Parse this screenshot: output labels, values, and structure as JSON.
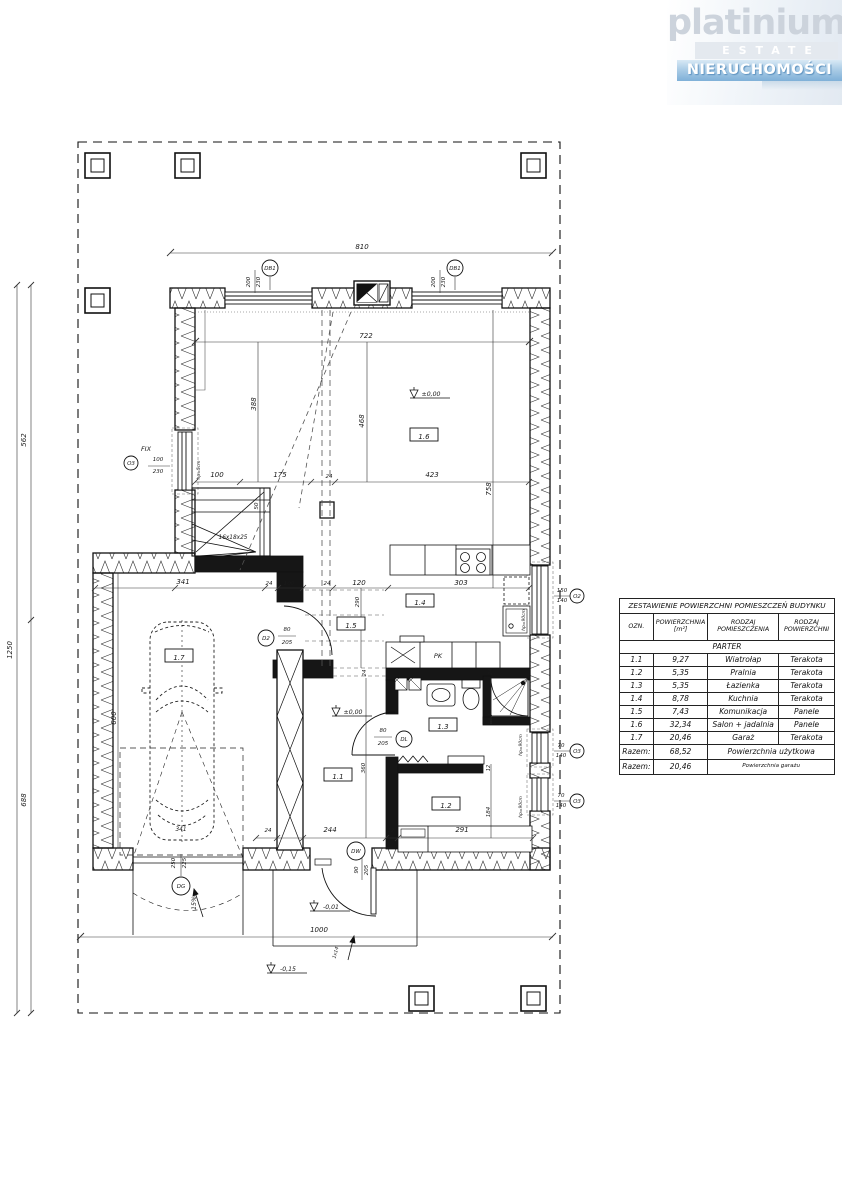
{
  "logo": {
    "brand": "platinium",
    "estate": "ESTATE",
    "tagline": "NIERUCHOMOŚCI"
  },
  "table": {
    "title": "ZESTAWIENIE POWIERZCHNI POMIESZCZEŃ BUDYNKU",
    "headers": [
      "OZN.",
      "POWIERZCHNIA [m²]",
      "RODZAJ POMIESZCZENIA",
      "RODZAJ POWIERZCHNI"
    ],
    "section": "PARTER",
    "rows": [
      [
        "1.1",
        "9,27",
        "Wiatrołap",
        "Terakota"
      ],
      [
        "1.2",
        "5,35",
        "Pralnia",
        "Terakota"
      ],
      [
        "1.3",
        "5,35",
        "Łazienka",
        "Terakota"
      ],
      [
        "1.4",
        "8,78",
        "Kuchnia",
        "Terakota"
      ],
      [
        "1.5",
        "7,43",
        "Komunikacja",
        "Panele"
      ],
      [
        "1.6",
        "32,34",
        "Salon + jadalnia",
        "Panele"
      ],
      [
        "1.7",
        "20,46",
        "Garaż",
        "Terakota"
      ]
    ],
    "totals": [
      {
        "label": "Razem:",
        "value": "68,52",
        "desc": "Powierzchnia użytkowa"
      },
      {
        "label": "Razem:",
        "value": "20,46",
        "desc": "Powierzchnia garażu"
      }
    ]
  },
  "plan": {
    "rooms": [
      {
        "id": "1.1",
        "x": 338,
        "y": 777
      },
      {
        "id": "1.2",
        "x": 446,
        "y": 806
      },
      {
        "id": "1.3",
        "x": 443,
        "y": 727
      },
      {
        "id": "1.4",
        "x": 420,
        "y": 603
      },
      {
        "id": "1.5",
        "x": 351,
        "y": 626
      },
      {
        "id": "1.6",
        "x": 424,
        "y": 437
      },
      {
        "id": "1.7",
        "x": 179,
        "y": 658
      }
    ],
    "circles": [
      {
        "t": "DB1",
        "x": 270,
        "y": 268,
        "r": 8
      },
      {
        "t": "DB1",
        "x": 455,
        "y": 268,
        "r": 8
      },
      {
        "t": "O3",
        "x": 131,
        "y": 463,
        "r": 7
      },
      {
        "t": "O2",
        "x": 577,
        "y": 596,
        "r": 7
      },
      {
        "t": "O3",
        "x": 577,
        "y": 751,
        "r": 7
      },
      {
        "t": "O3",
        "x": 577,
        "y": 801,
        "r": 7
      },
      {
        "t": "D2",
        "x": 266,
        "y": 638,
        "r": 8
      },
      {
        "t": "DL",
        "x": 404,
        "y": 739,
        "r": 8
      },
      {
        "t": "DW",
        "x": 356,
        "y": 851,
        "r": 9
      },
      {
        "t": "DG",
        "x": 181,
        "y": 886,
        "r": 9
      }
    ],
    "labels": [
      {
        "t": "810",
        "x": 362,
        "y": 249
      },
      {
        "t": "200",
        "x": 250,
        "y": 282,
        "r": -90,
        "fs": 5.5
      },
      {
        "t": "230",
        "x": 260,
        "y": 282,
        "r": -90,
        "fs": 5.5
      },
      {
        "t": "200",
        "x": 435,
        "y": 282,
        "r": -90,
        "fs": 5.5
      },
      {
        "t": "230",
        "x": 445,
        "y": 282,
        "r": -90,
        "fs": 5.5
      },
      {
        "t": "722",
        "x": 366,
        "y": 338
      },
      {
        "t": "388",
        "x": 256,
        "y": 404,
        "r": -90
      },
      {
        "t": "468",
        "x": 364,
        "y": 421,
        "r": -90
      },
      {
        "t": "100",
        "x": 217,
        "y": 477
      },
      {
        "t": "175",
        "x": 280,
        "y": 477
      },
      {
        "t": "24",
        "x": 329,
        "y": 478,
        "fs": 5.5
      },
      {
        "t": "423",
        "x": 432,
        "y": 477
      },
      {
        "t": "50",
        "x": 258,
        "y": 506,
        "r": -90,
        "fs": 5.5
      },
      {
        "t": "758",
        "x": 491,
        "y": 489,
        "r": -90
      },
      {
        "t": "16x18x25",
        "x": 233,
        "y": 539,
        "fs": 5.8
      },
      {
        "t": "FIX",
        "x": 146,
        "y": 451,
        "fs": 6.5
      },
      {
        "t": "100",
        "x": 158,
        "y": 461,
        "fs": 5.5
      },
      {
        "t": "230",
        "x": 158,
        "y": 473,
        "fs": 5.5
      },
      {
        "t": "hp=5cm",
        "x": 200,
        "y": 470,
        "r": -90,
        "fs": 4.4
      },
      {
        "t": "341",
        "x": 183,
        "y": 584
      },
      {
        "t": "24",
        "x": 269,
        "y": 585,
        "fs": 5.5
      },
      {
        "t": "100",
        "x": 289,
        "y": 585,
        "fs": 5.5
      },
      {
        "t": "24",
        "x": 327,
        "y": 585,
        "fs": 5.5
      },
      {
        "t": "120",
        "x": 359,
        "y": 585
      },
      {
        "t": "303",
        "x": 461,
        "y": 585
      },
      {
        "t": "150",
        "x": 562,
        "y": 592,
        "fs": 5.5
      },
      {
        "t": "140",
        "x": 562,
        "y": 602,
        "fs": 5.5
      },
      {
        "t": "290",
        "x": 359,
        "y": 602,
        "r": -90,
        "fs": 5.5
      },
      {
        "t": "24",
        "x": 366,
        "y": 673,
        "r": -90,
        "fs": 5.5
      },
      {
        "t": "PK",
        "x": 438,
        "y": 658,
        "fs": 6.5
      },
      {
        "t": "hp=90cm",
        "x": 525,
        "y": 620,
        "r": -90,
        "fs": 4.4
      },
      {
        "t": "24",
        "x": 492,
        "y": 672,
        "r": -90,
        "fs": 5.5
      },
      {
        "t": "184",
        "x": 492,
        "y": 719,
        "r": -90,
        "fs": 5.5
      },
      {
        "t": "70",
        "x": 561,
        "y": 747,
        "fs": 5.5
      },
      {
        "t": "140",
        "x": 561,
        "y": 757,
        "fs": 5.5
      },
      {
        "t": "70",
        "x": 561,
        "y": 797,
        "fs": 5.5
      },
      {
        "t": "140",
        "x": 561,
        "y": 807,
        "fs": 5.5
      },
      {
        "t": "hp=90cm",
        "x": 522,
        "y": 745,
        "r": -90,
        "fs": 4.4
      },
      {
        "t": "hp=90cm",
        "x": 522,
        "y": 807,
        "r": -90,
        "fs": 4.4
      },
      {
        "t": "80",
        "x": 287,
        "y": 631,
        "fs": 5.5
      },
      {
        "t": "205",
        "x": 287,
        "y": 644,
        "fs": 5.5
      },
      {
        "t": "80",
        "x": 383,
        "y": 732,
        "fs": 5.5
      },
      {
        "t": "205",
        "x": 383,
        "y": 745,
        "fs": 5.5
      },
      {
        "t": "360",
        "x": 365,
        "y": 768,
        "r": -90,
        "fs": 5.5
      },
      {
        "t": "12",
        "x": 490,
        "y": 768,
        "r": -90,
        "fs": 5
      },
      {
        "t": "184",
        "x": 490,
        "y": 812,
        "r": -90,
        "fs": 5.5
      },
      {
        "t": "24",
        "x": 268,
        "y": 832,
        "fs": 5.5
      },
      {
        "t": "244",
        "x": 330,
        "y": 832
      },
      {
        "t": "12",
        "x": 391,
        "y": 832,
        "fs": 5
      },
      {
        "t": "291",
        "x": 462,
        "y": 832
      },
      {
        "t": "600",
        "x": 116,
        "y": 718,
        "r": -90
      },
      {
        "t": "341",
        "x": 181,
        "y": 831,
        "fs": 5.8
      },
      {
        "t": "250",
        "x": 175,
        "y": 863,
        "r": -90,
        "fs": 5.5
      },
      {
        "t": "225",
        "x": 186,
        "y": 863,
        "r": -90,
        "fs": 5.5
      },
      {
        "t": "15%",
        "x": 196,
        "y": 903,
        "r": -90,
        "fs": 6.2
      },
      {
        "t": "90",
        "x": 358,
        "y": 870,
        "r": -90,
        "fs": 5.5
      },
      {
        "t": "205",
        "x": 368,
        "y": 870,
        "r": -90,
        "fs": 5.5
      },
      {
        "t": "±0,00",
        "x": 431,
        "y": 396,
        "fs": 6.2
      },
      {
        "t": "±0,00",
        "x": 353,
        "y": 714,
        "fs": 6.2
      },
      {
        "t": "-0,01",
        "x": 331,
        "y": 909,
        "fs": 6.2
      },
      {
        "t": "1000",
        "x": 319,
        "y": 932
      },
      {
        "t": "1x14",
        "x": 337,
        "y": 953,
        "r": -75,
        "fs": 4.8
      },
      {
        "t": "-0,15",
        "x": 288,
        "y": 971,
        "fs": 6.2
      },
      {
        "t": "562",
        "x": 26,
        "y": 440,
        "r": -90
      },
      {
        "t": "688",
        "x": 26,
        "y": 800,
        "r": -90
      },
      {
        "t": "1250",
        "x": 12,
        "y": 650,
        "r": -90
      }
    ]
  }
}
